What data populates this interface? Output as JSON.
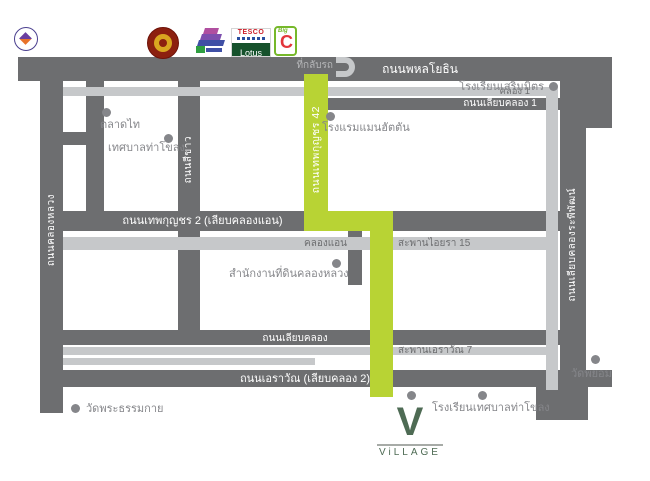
{
  "colors": {
    "road": "#6d6e70",
    "canal": "#c6c8ca",
    "route_green": "#b8d334",
    "brand_green": "#4e6b54",
    "label_gray": "#85868a"
  },
  "roads": {
    "phahonyothin": {
      "label": "ถนนพหลโยธิน"
    },
    "liap_khlong_1": {
      "label": "ถนนเลียบคลอง 1"
    },
    "thepkunchorn_2": {
      "label": "ถนนเทพกุญชร 2 (เลียบคลองแอน)"
    },
    "liap_khlong": {
      "label": "ถนนเลียบคลอง"
    },
    "erawan": {
      "label": "ถนนเอราวัณ (เลียบคลอง 2)"
    },
    "khlong_luang": {
      "label": "ถนนคลองหลวง"
    },
    "si_khao": {
      "label": "ถนนสีขาว"
    },
    "thepkunchorn_42": {
      "label": "ถนนเทพกุญชร 42"
    },
    "rapiphat": {
      "label": "ถนนเลียบคลองระพีพัฒน์"
    }
  },
  "canals": {
    "khlong_1": {
      "label": "คลอง 1"
    },
    "khlong_an": {
      "label": "คลองแอน"
    },
    "aiyara_15": {
      "label": "สะพานไอยรา 15"
    },
    "erawan_7": {
      "label": "สะพานเอราวัณ 7"
    }
  },
  "places": {
    "sermmit_school": {
      "label": "โรงเรียนเสริมมิตร"
    },
    "manhattan_hotel": {
      "label": "โรงแรมแมนฮัตตัน"
    },
    "talaad_thai": {
      "label": "ตลาดไท"
    },
    "thakhlong_municipality": {
      "label": "เทศบาลท่าโขลง"
    },
    "khlong_luang_land_office": {
      "label": "สำนักงานที่ดินคลองหลวง"
    },
    "wat_phra_dhammakaya": {
      "label": "วัดพระธรรมกาย"
    },
    "thakhlong_municipal_school": {
      "label": "โรงเรียนเทศบาลท่าโขลง"
    },
    "wat_phayom": {
      "label": "วัดพยอม"
    }
  },
  "uturn": {
    "label": "ที่กลับรถ"
  },
  "brand": {
    "letter": "V",
    "wordmark": "ViLLAGE"
  },
  "logos": {
    "tesco": {
      "top": "TESCO",
      "bottom": "Lotus"
    },
    "bigc": {
      "small": "Big",
      "big": "C"
    }
  }
}
